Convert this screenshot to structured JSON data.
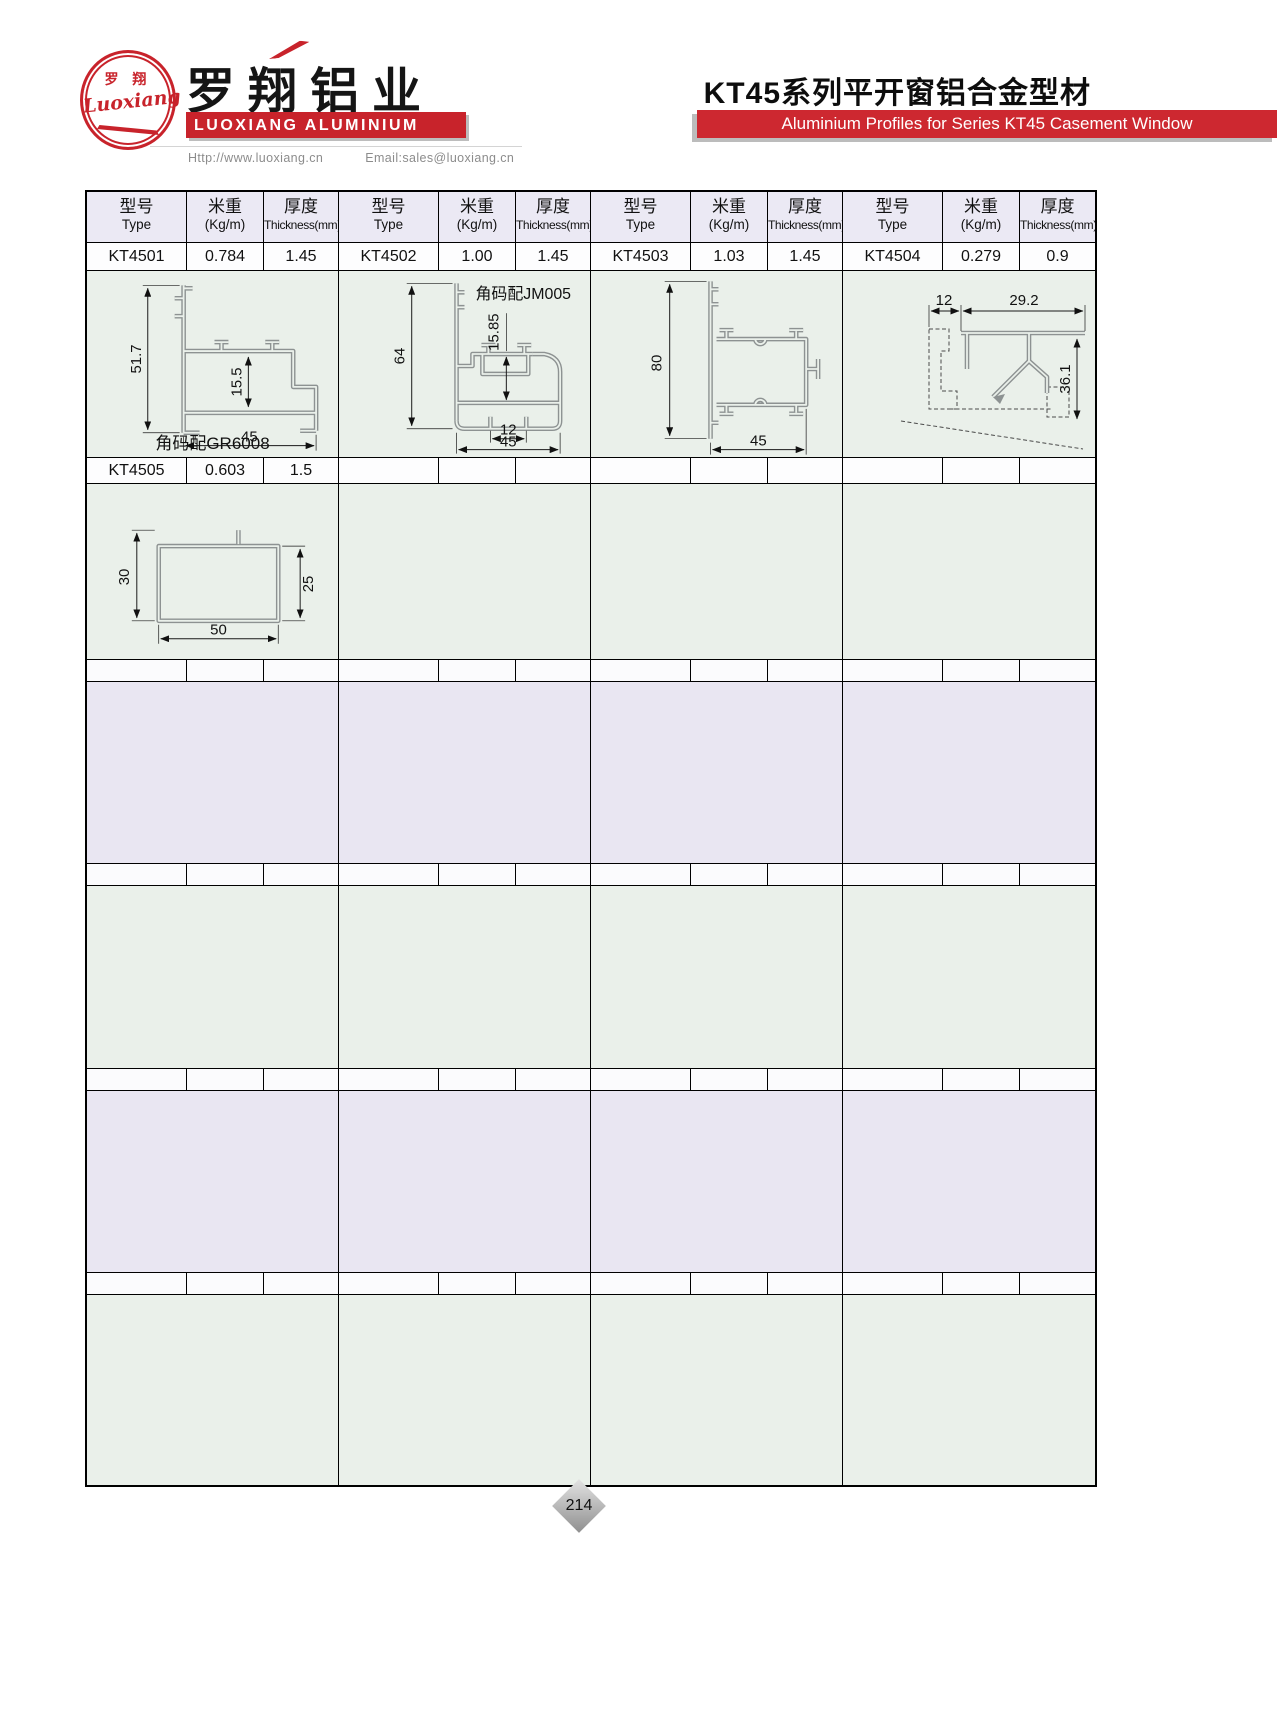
{
  "brand": {
    "logo_text_cn": "罗 翔",
    "logo_script": "Luoxiang",
    "company_cn": "罗翔铝业",
    "company_en": "LUOXIANG ALUMINIUM",
    "url": "Http://www.luoxiang.cn",
    "email": "Email:sales@luoxiang.cn"
  },
  "title": {
    "cn": "KT45系列平开窗铝合金型材",
    "en": "Aluminium Profiles for Series KT45 Casement Window"
  },
  "table": {
    "headers": {
      "type_cn": "型号",
      "type_en": "Type",
      "weight_cn": "米重",
      "weight_en": "(Kg/m)",
      "thickness_cn": "厚度",
      "thickness_en": "Thickness(mm)"
    },
    "row1": {
      "c1_type": "KT4501",
      "c1_kgm": "0.784",
      "c1_thk": "1.45",
      "c2_type": "KT4502",
      "c2_kgm": "1.00",
      "c2_thk": "1.45",
      "c3_type": "KT4503",
      "c3_kgm": "1.03",
      "c3_thk": "1.45",
      "c4_type": "KT4504",
      "c4_kgm": "0.279",
      "c4_thk": "0.9"
    },
    "row2": {
      "c1_type": "KT4505",
      "c1_kgm": "0.603",
      "c1_thk": "1.5"
    },
    "drawings": {
      "kt4501": {
        "dim_height": "51.7",
        "dim_inner": "15.5",
        "dim_width": "45",
        "note": "角码配GR6008"
      },
      "kt4502": {
        "note": "角码配JM005",
        "dim_height": "64",
        "dim_inner": "15.85",
        "dim_slot": "12",
        "dim_width": "45"
      },
      "kt4503": {
        "dim_height": "80",
        "dim_width": "45"
      },
      "kt4504": {
        "dim_offset": "12",
        "dim_width": "29.2",
        "dim_height": "36.1"
      },
      "kt4505": {
        "dim_left": "30",
        "dim_right": "25",
        "dim_width": "50"
      }
    }
  },
  "footer": {
    "page": "214"
  },
  "colors": {
    "brand_red": "#c8232b",
    "bar_red": "#cd2830",
    "band_mint": "#eaf0ea",
    "band_lavender": "#e9e6f2",
    "header_lavender": "#ebe9f4",
    "profile_gray": "#8d9292",
    "shadow_gray": "#bcbcbc"
  }
}
